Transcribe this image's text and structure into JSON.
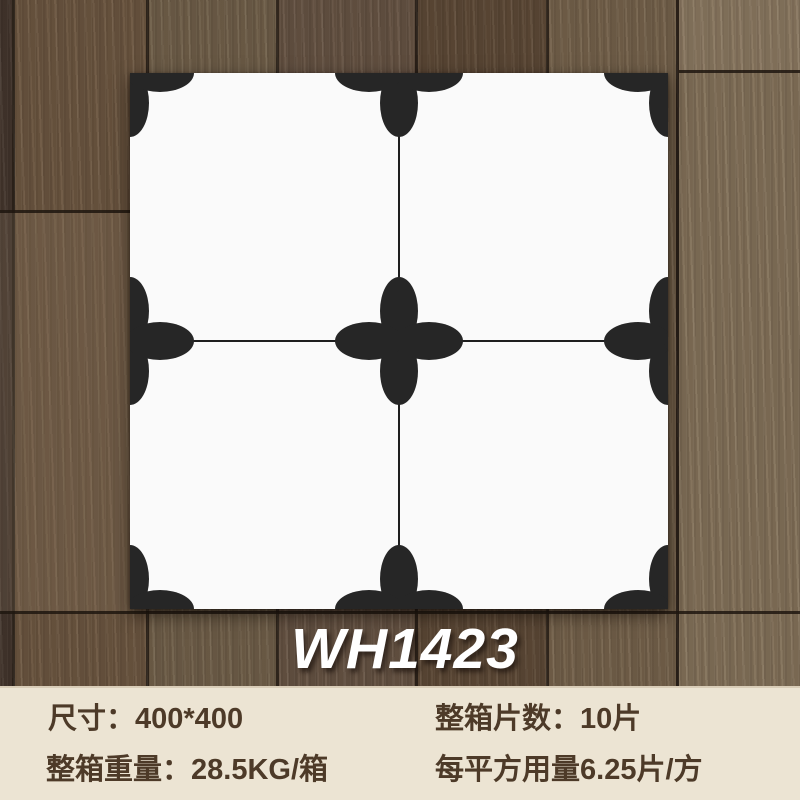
{
  "product": {
    "model": "WH1423",
    "pattern_description": "white tile 2x2 grid with black four-petal flowers at corners, edge midpoints and center, joined by thin lines"
  },
  "specs": {
    "size": {
      "label": "尺寸：",
      "value": "400*400"
    },
    "pieces": {
      "label": "整箱片数：",
      "value": "10片"
    },
    "weight": {
      "label": "整箱重量：",
      "value": "28.5KG/箱"
    },
    "usage": {
      "label": "每平方用量",
      "value": "6.25片/方"
    }
  },
  "colors": {
    "pattern_black": "#262626",
    "tile_white": "#fafafa",
    "panel_bg": "#ece4d3",
    "spec_text": "#4d3a28",
    "model_text": "#ffffff",
    "wood_dark": "#5b4836",
    "wood_light": "#82715a"
  }
}
